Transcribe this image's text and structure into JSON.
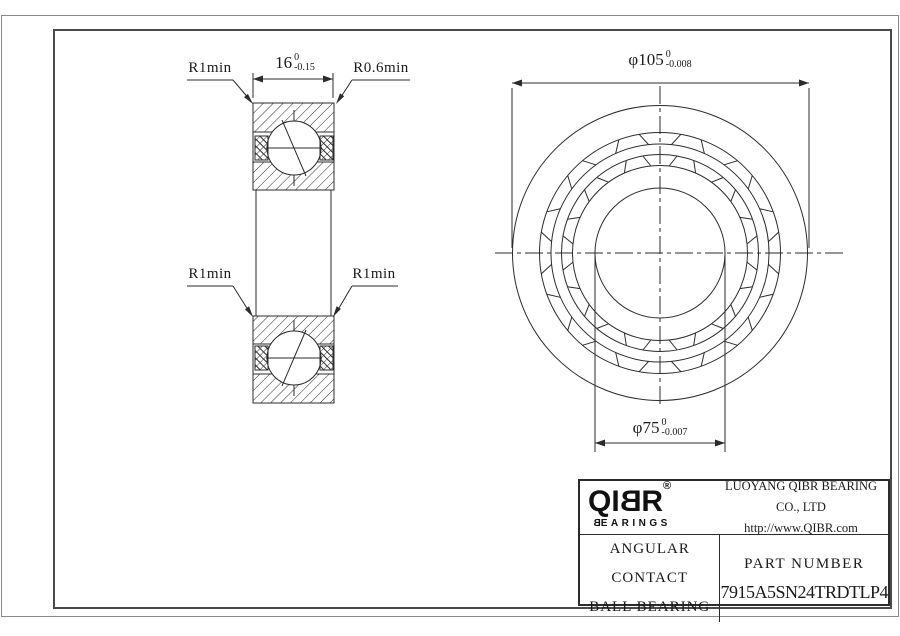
{
  "drawing": {
    "labels": {
      "r1_top_left": "R1min",
      "r06_top_right": "R0.6min",
      "r1_bottom_left": "R1min",
      "r1_bottom_right": "R1min"
    },
    "dimensions": {
      "width": {
        "value": "16",
        "tol_upper": "0",
        "tol_lower": "-0.15"
      },
      "outer_diameter": {
        "value": "φ105",
        "tol_upper": "0",
        "tol_lower": "-0.008"
      },
      "bore_diameter": {
        "value": "φ75",
        "tol_upper": "0",
        "tol_lower": "-0.007"
      }
    }
  },
  "title_block": {
    "logo": {
      "text_start": "QI",
      "text_mirrored": "B",
      "text_end": "R",
      "registered": "®",
      "sub_mirrored": "B",
      "sub_end": "EARINGS"
    },
    "company": "LUOYANG QIBR BEARING CO., LTD",
    "website": "http://www.QIBR.com",
    "product_line1": "ANGULAR CONTACT",
    "product_line2": "BALL BEARING",
    "part_number_label": "PART NUMBER",
    "part_number": "7915A5SN24TRDTLP4"
  },
  "colors": {
    "line": "#2b2b2b",
    "background": "#ffffff"
  }
}
